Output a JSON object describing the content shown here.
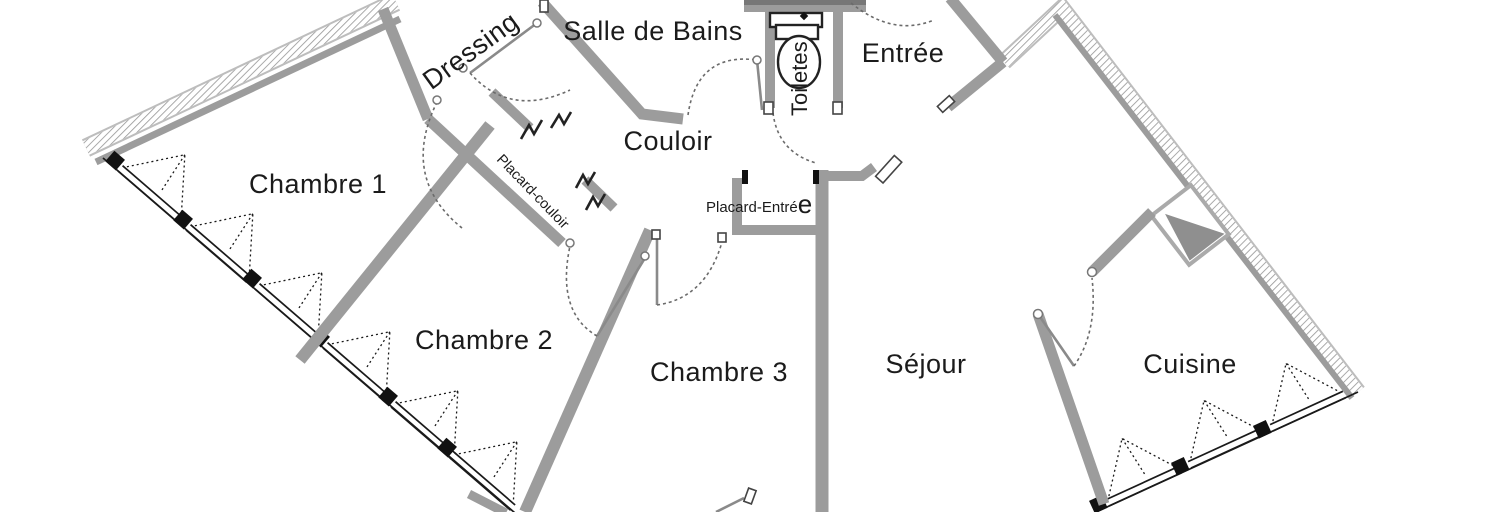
{
  "meta": {
    "type": "apartment floor plan",
    "language": "fr"
  },
  "colors": {
    "wall": "#9c9c9c",
    "exterior_hatch": "#9a9a9a",
    "text": "#1b1b1b",
    "window_line": "#1a1a1a",
    "background": "#ffffff"
  },
  "rooms": {
    "chambre1": {
      "label": "Chambre 1"
    },
    "chambre2": {
      "label": "Chambre 2"
    },
    "chambre3": {
      "label": "Chambre 3"
    },
    "sejour": {
      "label": "Séjour"
    },
    "cuisine": {
      "label": "Cuisine"
    },
    "entree": {
      "label": "Entrée"
    },
    "couloir": {
      "label": "Couloir"
    },
    "salle_de_bains": {
      "label": "Salle de Bains"
    },
    "dressing": {
      "label": "Dressing"
    },
    "toilettes": {
      "label": "Toiletes"
    },
    "placard_couloir": {
      "label": "Placard-couloir"
    },
    "placard_entree": {
      "label_small": "Placard-Entré",
      "label_big": "e"
    }
  }
}
